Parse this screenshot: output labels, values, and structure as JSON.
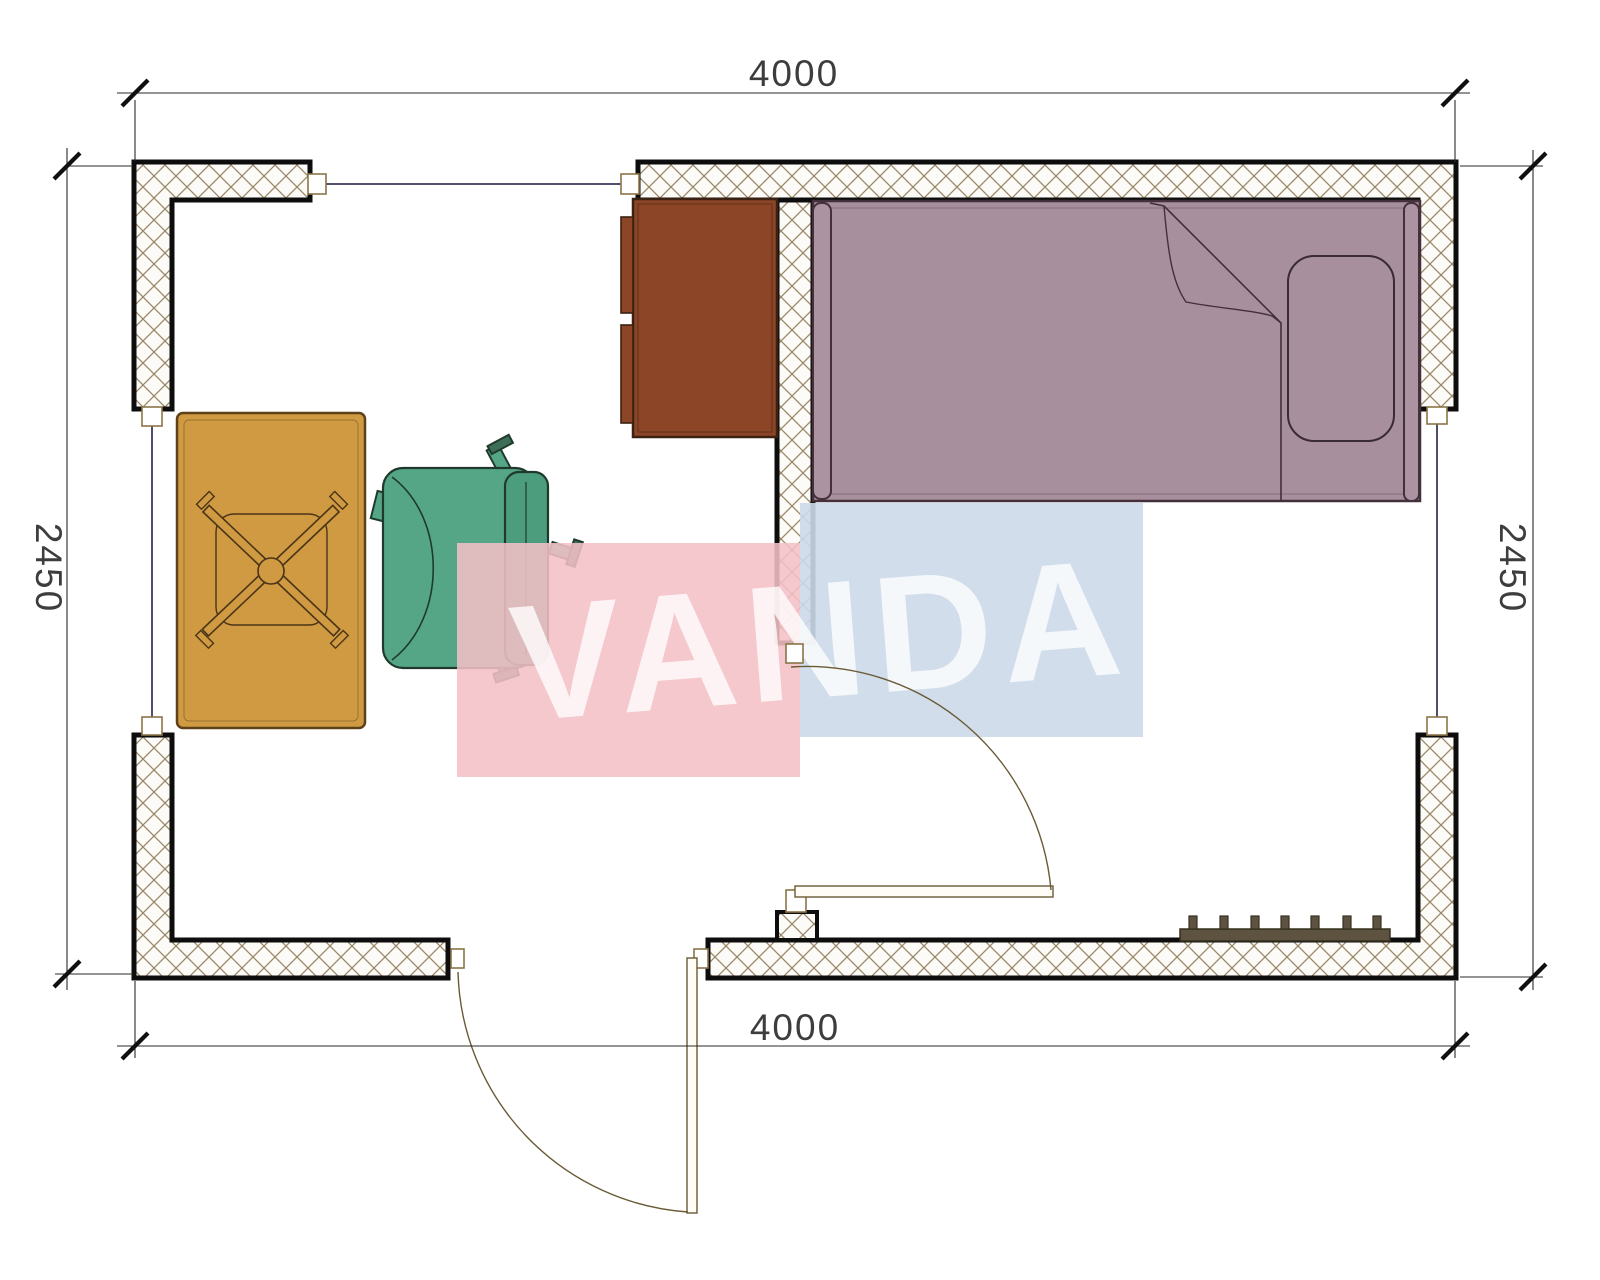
{
  "dims": {
    "top": "4000",
    "bottom": "4000",
    "left": "2450",
    "right": "2450"
  },
  "watermark": {
    "text": "VANDA",
    "pink_color": "#f3c0c6",
    "blue_color": "#ccd9e9",
    "letter_color": "rgba(255,255,255,0.78)"
  },
  "colors": {
    "wall_border": "#0d0d0d",
    "hatch": "#9a8868",
    "bed": "#a78f9e",
    "bed_accent": "#ab93a2",
    "bed_line": "#43303b",
    "dresser": "#8c4527",
    "table": "#cf9a41",
    "table_line": "#4a3418",
    "chair": "#55a687",
    "chair_back": "#4c9c7e",
    "chair_line": "#1f3a2c",
    "radiator": "#5d5340",
    "radiator_line": "#36301f"
  }
}
